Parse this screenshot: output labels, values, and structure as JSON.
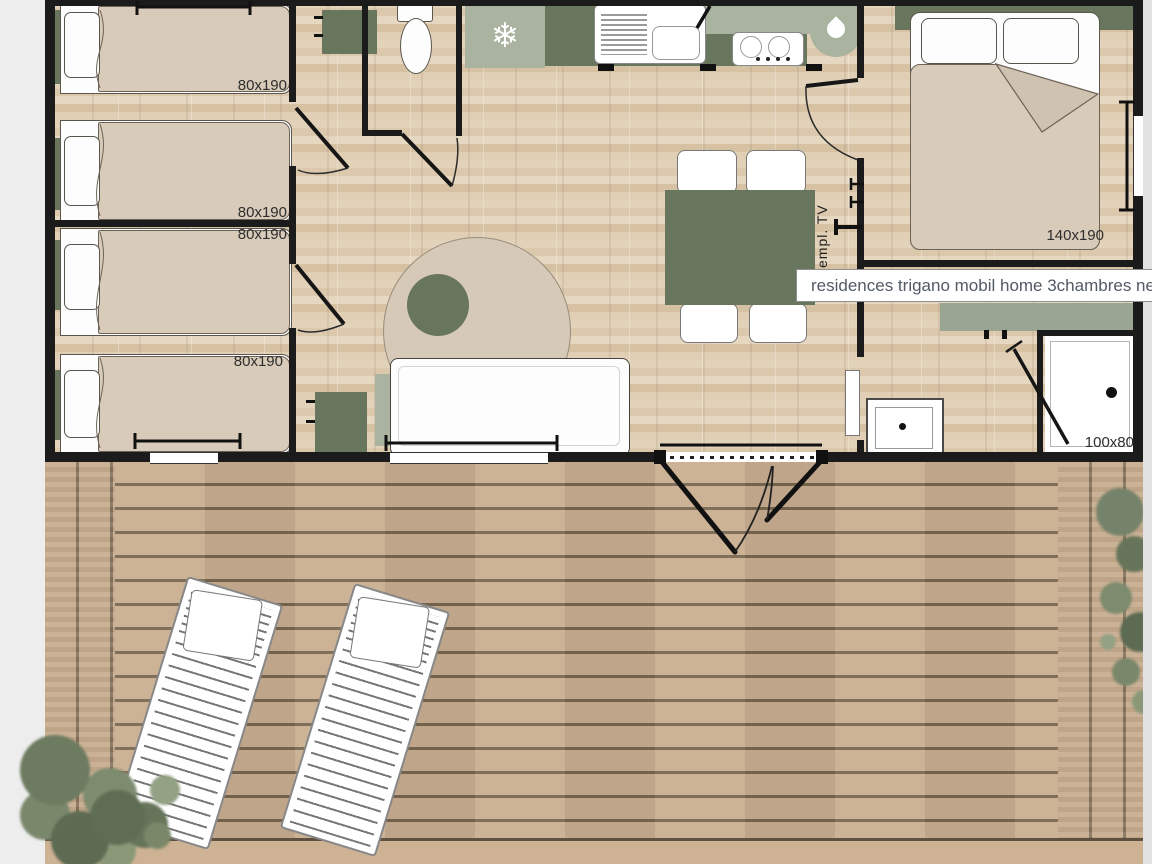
{
  "tooltip": {
    "text": "residences trigano mobil home 3chambres nest3"
  },
  "labels": {
    "bedroom1_bed_top": "80x190",
    "bedroom1_bed_bottom": "80x190",
    "bedroom2_bed_top": "80x190",
    "bedroom2_bed_bottom": "80x190",
    "master_bedroom_bed": "140x190",
    "shower": "100x80",
    "tv_location": "empl. TV"
  },
  "icons": {
    "snowflake": "❄",
    "water_drop": "css-teardrop-shape"
  },
  "colors": {
    "wall": "#1b1b1b",
    "sage_dark": "#68765d",
    "sage_light": "#a9b3a0",
    "floor_wood": "#ddcab0",
    "deck_wood": "#c9ae90",
    "mattress": "#d8cbb9",
    "tooltip_text": "#525a66",
    "page_background": "#ededed"
  }
}
